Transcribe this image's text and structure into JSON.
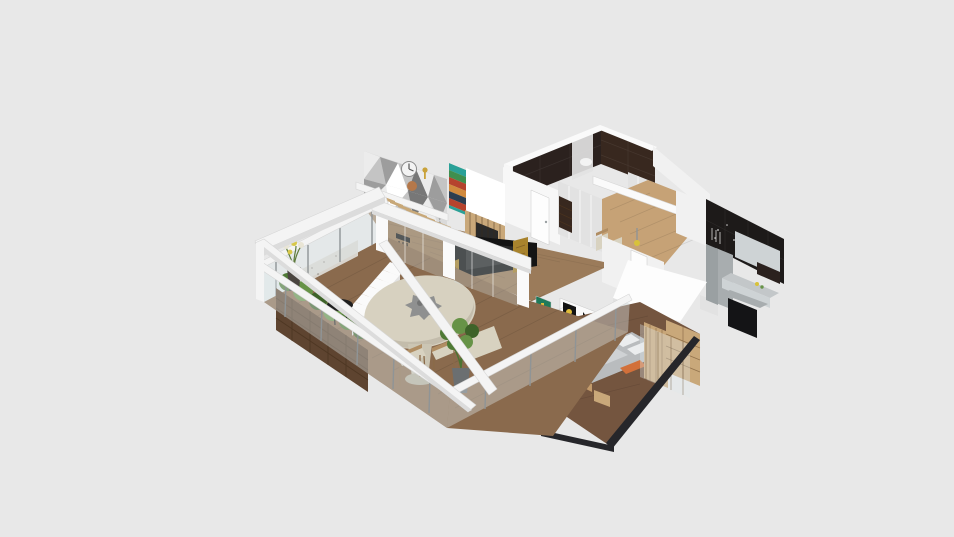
{
  "app": {
    "view_label": "3D dollhouse floor plan render",
    "background": "#e8e8e8"
  },
  "scene": {
    "rooms": [
      {
        "name": "balcony-terrace"
      },
      {
        "name": "living-dining-room"
      },
      {
        "name": "bathroom"
      },
      {
        "name": "closet-hall"
      },
      {
        "name": "kitchen"
      },
      {
        "name": "bedroom"
      }
    ],
    "objects": [
      "wood deck",
      "glass railing",
      "wood planter boxes",
      "flower vase",
      "round patio table",
      "patio chairs",
      "black bistro table",
      "potted plant",
      "white staircase",
      "floating wood stair treads",
      "pergola beams",
      "geometric triangle accent wall",
      "wall clock",
      "copper disc",
      "brass key decor",
      "chevron striped shelf art",
      "bar stool",
      "wood slat partition",
      "black tv wall",
      "gold mosaic panels",
      "bathroom dark tile walls",
      "shower panel",
      "white wardrobe",
      "second closet",
      "hallway wood floor",
      "ceiling beam",
      "dining chairs",
      "yellow pendant light",
      "dark marble kitchen wall",
      "gray kitchen cabinets",
      "fridge column",
      "kitchen counter",
      "black kitchen island",
      "white roof slab",
      "interior doors",
      "green art frame",
      "duo art frame",
      "bed with gray duvet",
      "orange pillow",
      "timber headboard panel",
      "bedroom wardrobe",
      "glass partition",
      "nightstand",
      "dark floor edge trim"
    ],
    "palette": {
      "bg": "#e8e8e8",
      "wallWhite": "#f7f7f7",
      "wallBright": "#ffffff",
      "wallSoft": "#f1f1f1",
      "wallShade": "#e2e2e2",
      "wallShade2": "#d2d2d2",
      "beamWhite": "#f4f4f4",
      "beamShade": "#dcdcdc",
      "capWhite": "#fafafa",
      "darkTile": "#2b211e",
      "darkTile2": "#38281f",
      "darkMarble": "#1d1a19",
      "doorWhite": "#fdfdfd",
      "woodHall": "#c6a276",
      "woodLiving": "#9b7b5a",
      "woodDeck": "#8a6a4d",
      "woodBedFloor": "#74553f",
      "woodTread": "#c8a878",
      "woodHead": "#c8a678",
      "woodWardrobe": "#c9a87a",
      "woodRail": "#c29a6b",
      "glass": "#dfe9ec",
      "glassDeep": "#cfdde2",
      "tableTop": "#d7d1c0",
      "tableShade": "#c3bcab",
      "tablePed": "#cbc5b3",
      "tableBase": "#b5ae9c",
      "centerpiece": "#8f9090",
      "centerpieceDark": "#737474",
      "planter": "#5e4430",
      "planterDark": "#4a3425",
      "green1": "#4e7a35",
      "green2": "#679347",
      "green3": "#3e6329",
      "potGray": "#6b6f71",
      "potDark": "#4a4540",
      "flowerWhite": "#e9e5d5",
      "flowerYellow": "#d8c84a",
      "blackUnit": "#141414",
      "screenGlint": "#2a2a2a",
      "stoolBlack": "#1f1f1f",
      "gold": "#a8832d",
      "goldDark": "#8a6a22",
      "cabGray": "#ced3d5",
      "fridgeGray": "#a8adaf",
      "counterGray": "#c3c7c9",
      "islandBlack": "#141416",
      "sideGray": "#9aa0a2",
      "bedGray": "#b9bcbe",
      "bedLight": "#cfd2d4",
      "pillowWhite": "#ebedee",
      "pillowOrange": "#d2703a",
      "artGreen": "#1f7a5a",
      "artYellow": "#e0bd3a",
      "clockFace": "#f3f3f3",
      "clockHand": "#555555",
      "copper": "#b5784a",
      "brass": "#c9a23a",
      "geoBase": "#dadada",
      "geoLight": "#ececec",
      "geoMid": "#c4c4c4",
      "geoDark": "#9d9d9d",
      "geoDarker": "#777777",
      "shelfTeal": "#2aa198",
      "shelfGreen": "#3f8f4f",
      "shelfRed": "#b5432e",
      "shelfOrange": "#d08a3e",
      "shelfNavy": "#2c3e50",
      "shelfCream": "#e0d8c4",
      "terrazzo": "#d8d4cd",
      "trimDark": "#26262a",
      "chairBeige": "#d8d2c0",
      "chairWood": "#b08d62",
      "pendantYellow": "#d8c23a",
      "benchSpeck": "#9a958e"
    }
  }
}
